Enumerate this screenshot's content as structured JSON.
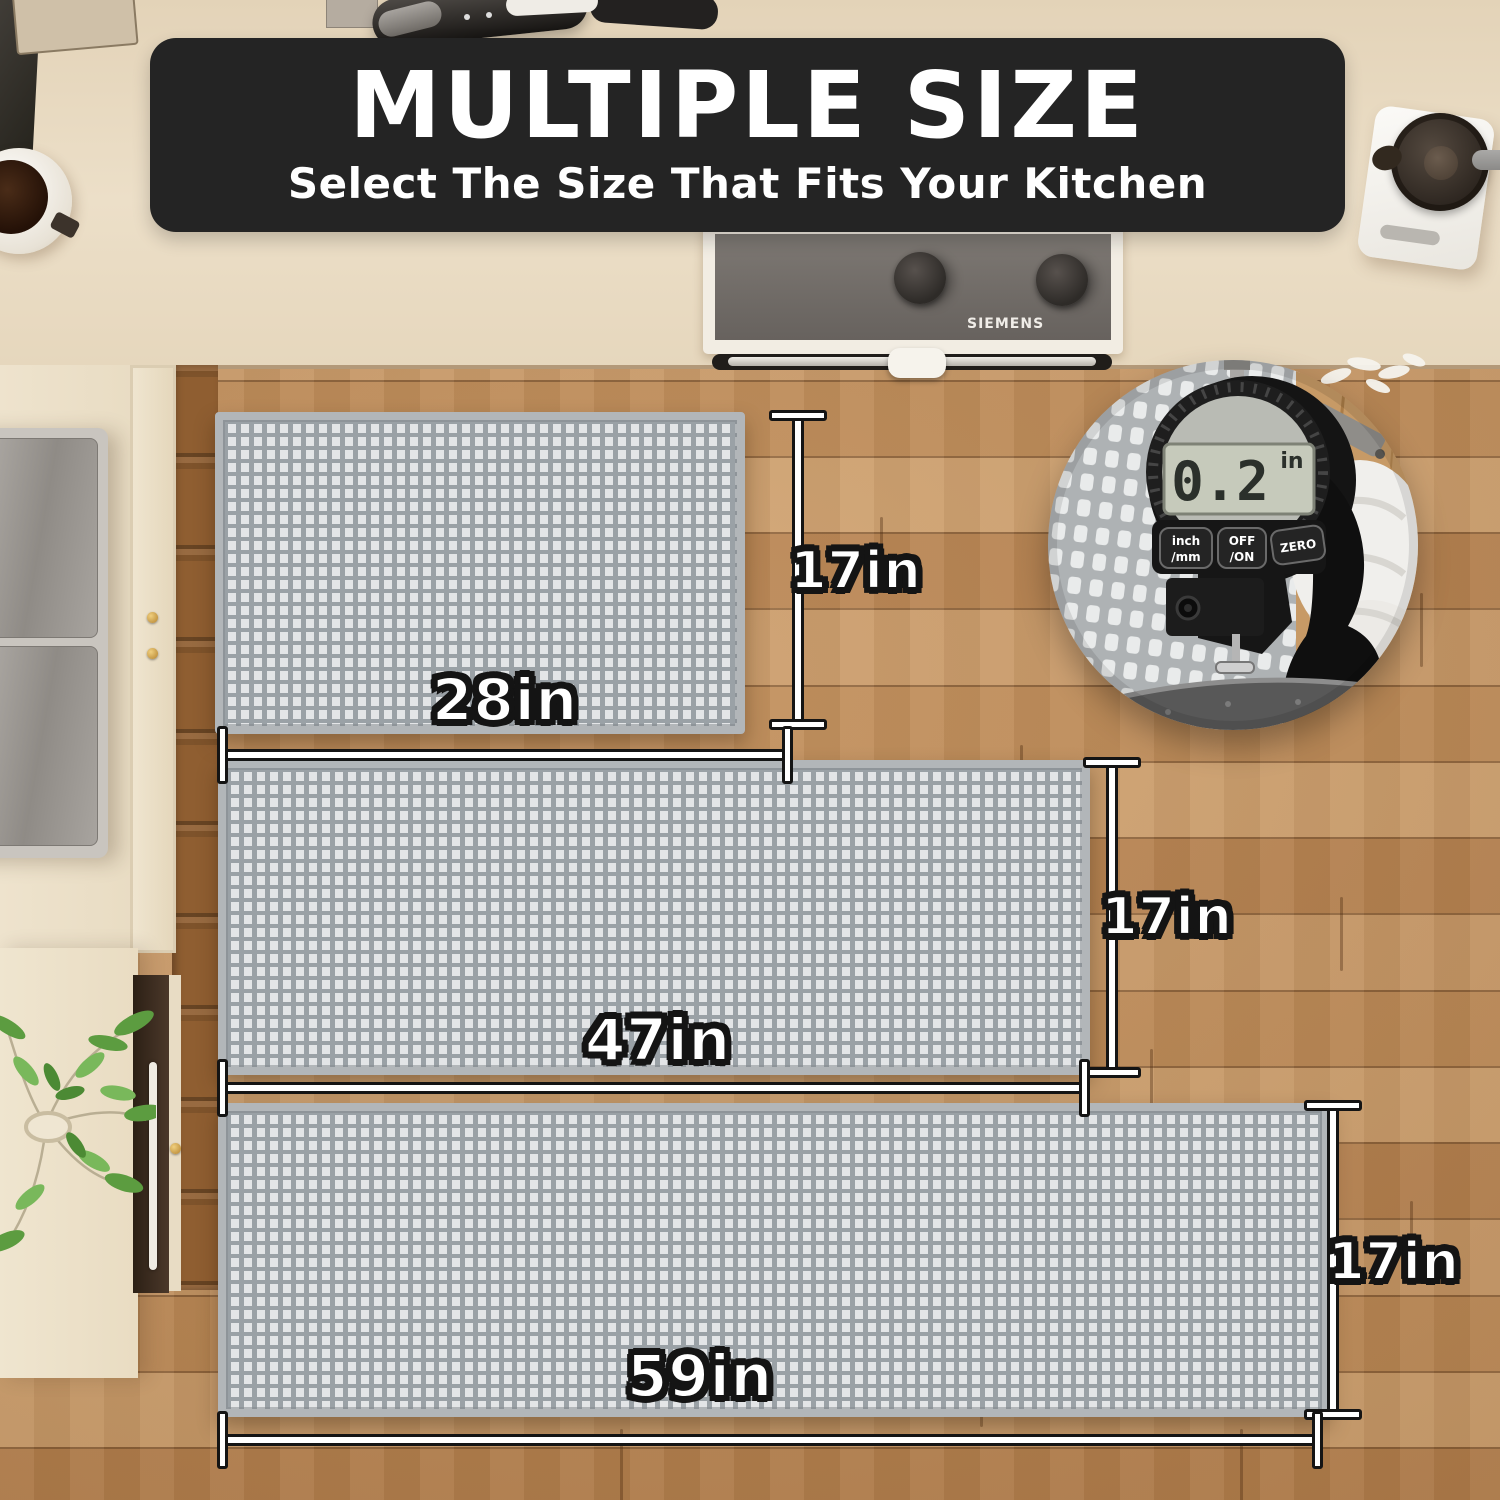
{
  "banner": {
    "title": "MULTIPLE SIZE",
    "subtitle": "Select The Size That Fits Your Kitchen",
    "bg_color": "#242424",
    "text_color": "#ffffff"
  },
  "mats": [
    {
      "id": "mat-small",
      "width_label": "28in",
      "height_label": "17in"
    },
    {
      "id": "mat-medium",
      "width_label": "47in",
      "height_label": "17in"
    },
    {
      "id": "mat-large",
      "width_label": "59in",
      "height_label": "17in"
    }
  ],
  "thickness_inset": {
    "display_value": "0.2",
    "display_unit": "in",
    "buttons": [
      {
        "line1": "inch",
        "line2": "/mm"
      },
      {
        "line1": "OFF",
        "line2": "/ON"
      },
      {
        "line1": "ZERO",
        "line2": ""
      }
    ]
  },
  "appliances": {
    "stove_brand": "SIEMENS"
  },
  "palette": {
    "banner_bg": "#242424",
    "mat_cell": "#e3e5e7",
    "mat_gap": "#9aa1a6",
    "mat_border": "#b2b6b9",
    "floor_wood": "#c6935f",
    "counter": "#ecdfc8",
    "dimension_line": "#ffffff",
    "dimension_outline": "#141414",
    "label_text": "#ffffff"
  }
}
